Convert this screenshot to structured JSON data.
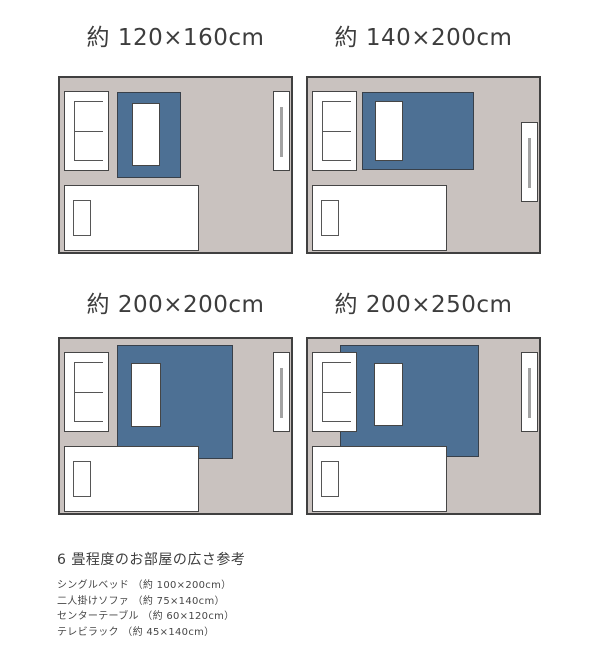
{
  "colors": {
    "background": "#ffffff",
    "room_floor": "#c9c2bf",
    "rug": "#4d7094",
    "outline": "#404040",
    "furniture_fill": "#ffffff",
    "tv_bar": "#a2a2a2",
    "title_text": "#3d3d3d",
    "legend_text": "#474747"
  },
  "panels": [
    {
      "label": "約 120×160cm",
      "rug_cm": "120×160",
      "rug_style": "left:57px;top:14px;width:64px;height:86px",
      "table_style": "left:72px;top:25px;width:28px;height:63px",
      "rack_style": "right:1px;top:13px;width:17px;height:80px"
    },
    {
      "label": "約 140×200cm",
      "rug_cm": "140×200",
      "rug_style": "left:54px;top:14px;width:112px;height:78px",
      "table_style": "left:67px;top:23px;width:28px;height:60px",
      "rack_style": "right:1px;top:44px;width:17px;height:80px"
    },
    {
      "label": "約 200×200cm",
      "rug_cm": "200×200",
      "rug_style": "left:57px;top:6px;width:116px;height:114px",
      "table_style": "left:71px;top:24px;width:30px;height:64px",
      "rack_style": "right:1px;top:13px;width:17px;height:80px"
    },
    {
      "label": "約 200×250cm",
      "rug_cm": "200×250",
      "rug_style": "left:32px;top:6px;width:139px;height:112px",
      "table_style": "left:66px;top:24px;width:29px;height:63px",
      "rack_style": "right:1px;top:13px;width:17px;height:80px"
    }
  ],
  "legend": {
    "heading": "6 畳程度のお部屋の広さ参考",
    "items": [
      "シングルベッド （約 100×200cm）",
      "二人掛けソファ （約 75×140cm）",
      "センターテーブル （約 60×120cm）",
      "テレビラック （約 45×140cm）"
    ]
  }
}
